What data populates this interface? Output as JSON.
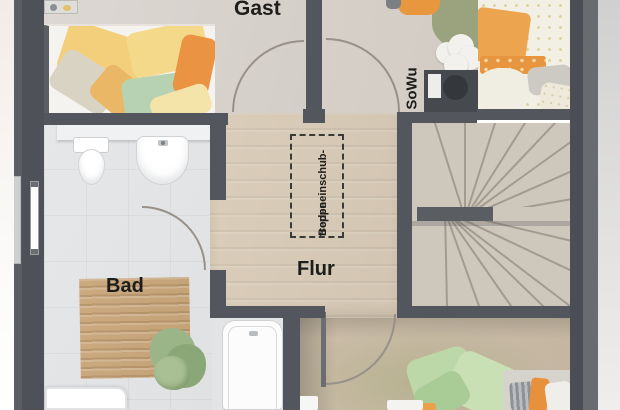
{
  "plan": {
    "rooms": {
      "gast": {
        "label": "Gast"
      },
      "bad": {
        "label": "Bad"
      },
      "flur": {
        "label": "Flur"
      },
      "sowu": {
        "label": "SoWu"
      }
    },
    "attic_hatch": {
      "line1": "Bodeneinschub-",
      "line2": "treppe"
    },
    "colors": {
      "wall": "#53565c",
      "floor_tile": "#e3e5e6",
      "floor_wood": "#d6c9b5",
      "stairs_floor": "#cec7bc",
      "accent_orange": "#ea9342",
      "accent_yellow": "#f3cf7c",
      "accent_green": "#b7d2b2",
      "mat_wood": "#c9a87e",
      "label_text": "#1d1d1b"
    }
  }
}
